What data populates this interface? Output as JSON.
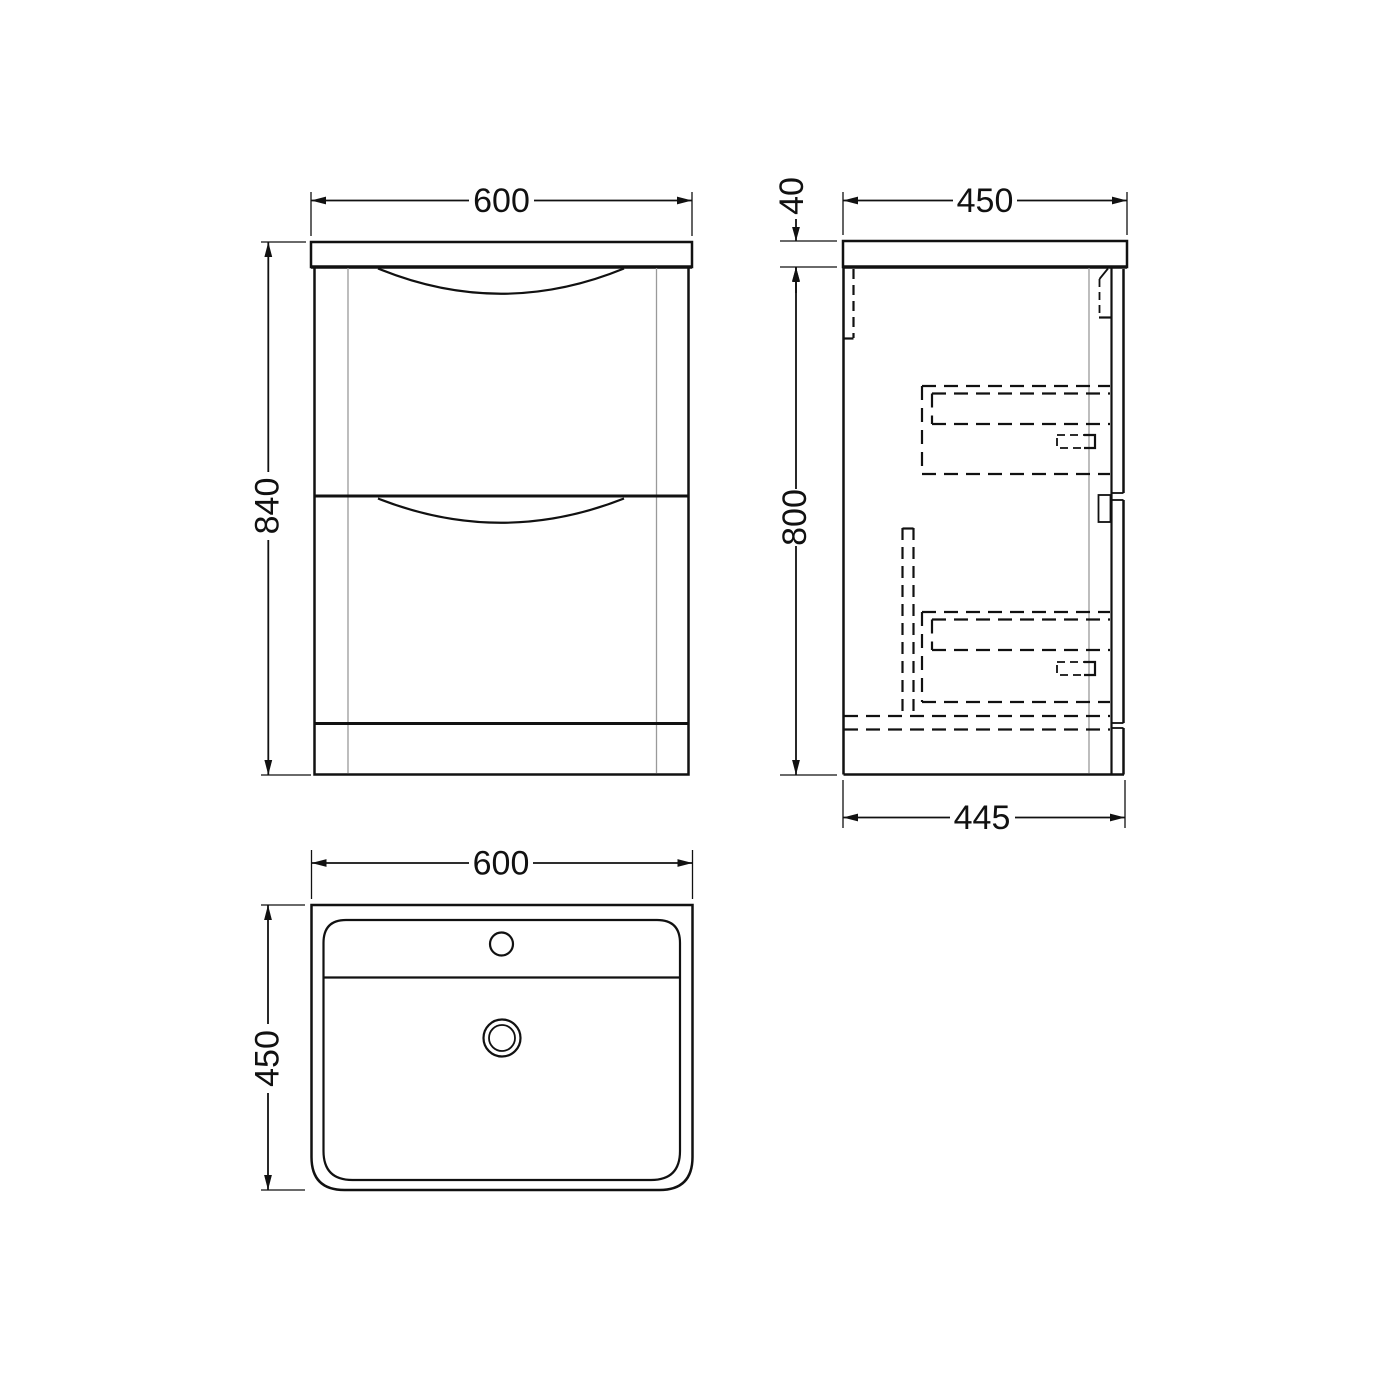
{
  "colors": {
    "line": "#111111",
    "soft_line": "#9a9a9a",
    "background": "#ffffff"
  },
  "views": {
    "front": {
      "dims": {
        "width": "600",
        "height": "840"
      }
    },
    "side": {
      "dims": {
        "worktop_depth": "450",
        "worktop_thickness": "40",
        "cabinet_height": "800",
        "base_depth": "445"
      }
    },
    "plan": {
      "dims": {
        "width": "600",
        "depth": "450"
      }
    }
  }
}
